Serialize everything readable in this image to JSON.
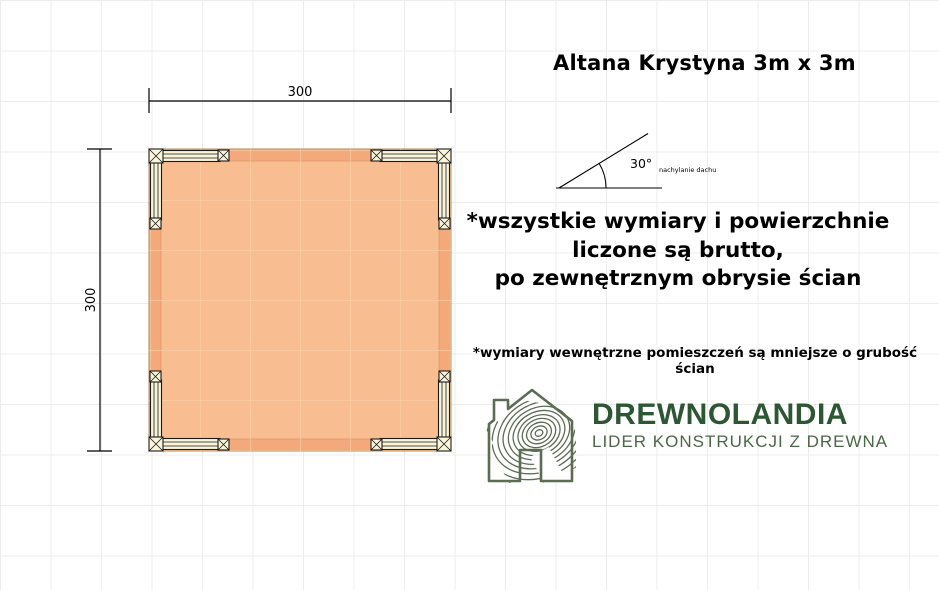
{
  "title": "Altana Krystyna 3m x 3m",
  "plan": {
    "width_label": "300",
    "height_label": "300",
    "colors": {
      "floor": "#f8bd90",
      "floor_edge_band": "#f3a97c",
      "floor_grid_line": "#fbcfa6",
      "floor_outline": "#bf8a58",
      "floor_inner_line": "#e0996a",
      "beam_fill": "#faf5da"
    }
  },
  "roof_diagram": {
    "angle_label": "30°",
    "caption": "nachylanie dachu"
  },
  "notes": {
    "main_lines": [
      "*wszystkie wymiary i powierzchnie",
      "liczone są brutto,",
      "po zewnętrznym obrysie ścian"
    ],
    "secondary": "*wymiary wewnętrzne pomieszczeń są mniejsze o grubość ścian"
  },
  "logo": {
    "brand": "DREWNOLANDIA",
    "tagline": "LIDER KONSTRUKCJI Z DREWNA",
    "brand_color": "#2d5733",
    "tagline_color": "#4a6847",
    "icon": "wood-grain-house-icon",
    "icon_color": "#5a6d52"
  }
}
